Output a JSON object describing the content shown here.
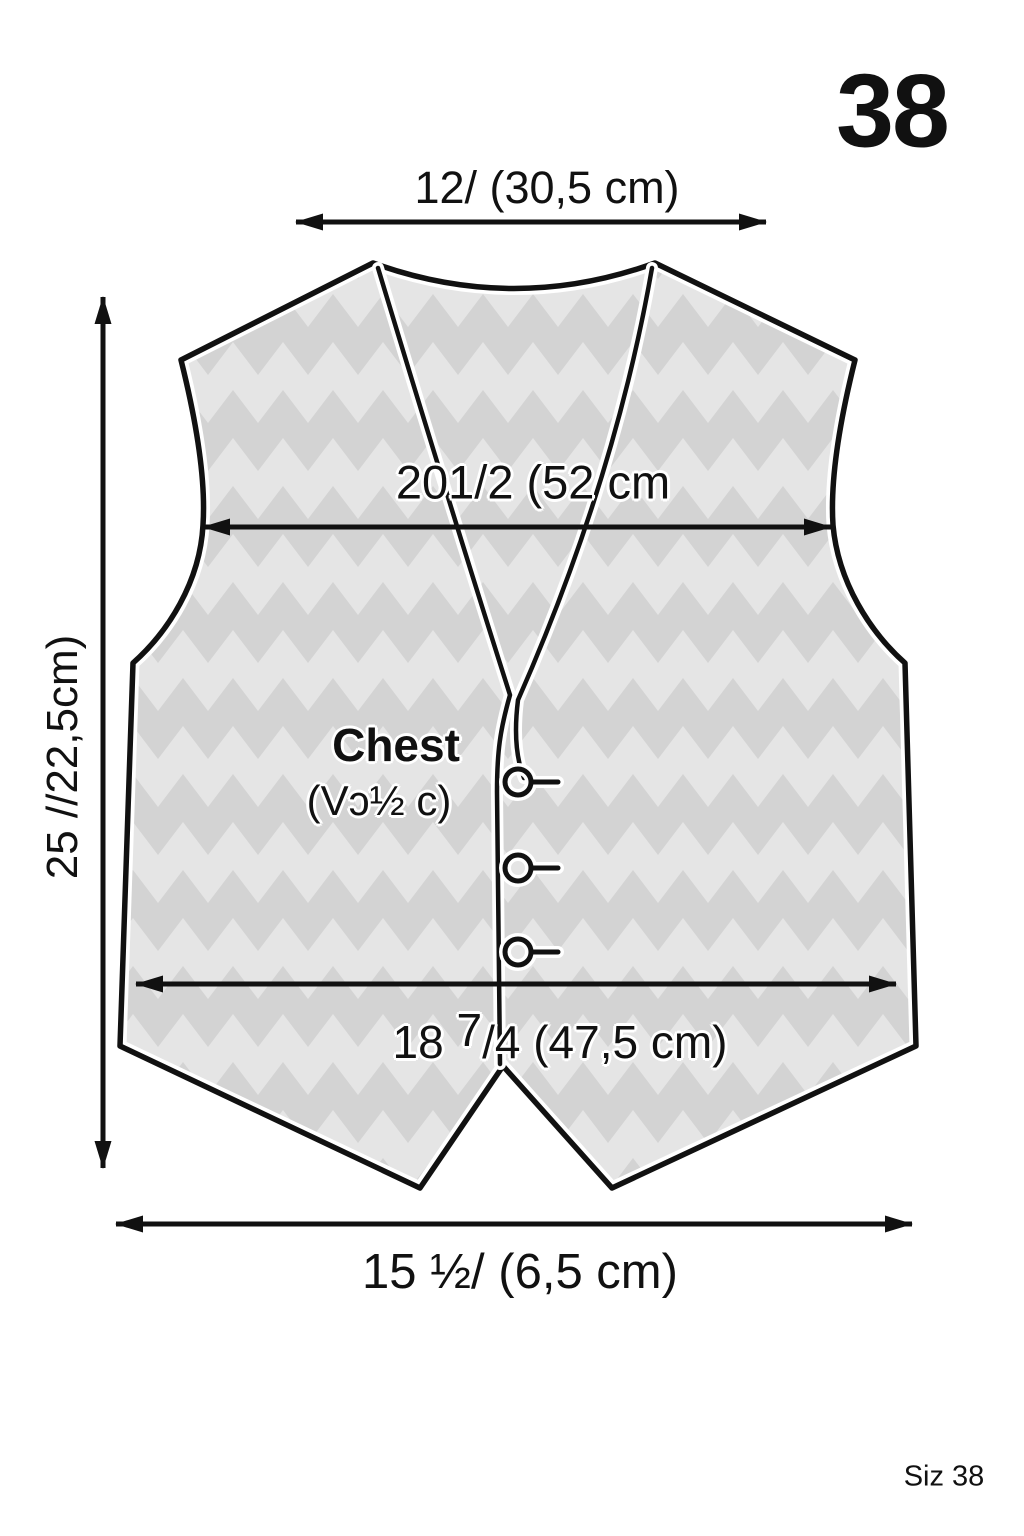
{
  "page": {
    "background": "#ffffff",
    "ink_color": "#111111"
  },
  "size_badge": "38",
  "footer": {
    "size_note": "Siz 38"
  },
  "garment": {
    "type": "vest-front-pattern",
    "button_count": 3,
    "chevron_light": "#e5e5e5",
    "chevron_dark": "#d3d3d3"
  },
  "measurements": {
    "shoulder_width": "12/ (30,5 cm)",
    "chest_width": "201/2 (52 cm",
    "side_length": "25 //22,5cm)",
    "hem_width": {
      "prefix": "18 ",
      "numerator": "7",
      "rest": "/4 (47,5 cm)"
    },
    "bottom_width": "15 ½/ (6,5 cm)",
    "chest_note_title": "Chest",
    "chest_note_value": "(Vɔ½ c)"
  }
}
